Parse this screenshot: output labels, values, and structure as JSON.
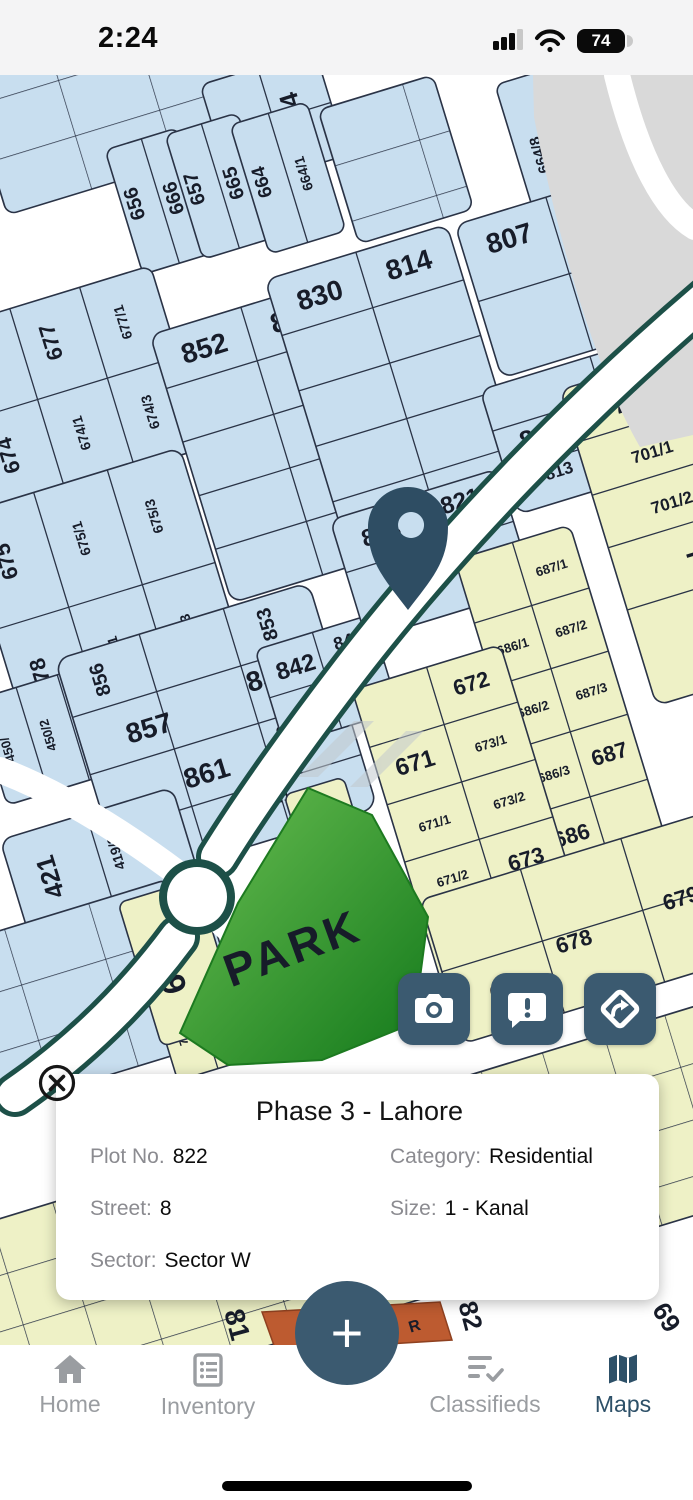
{
  "status_bar": {
    "time": "2:24",
    "battery_percent": "74"
  },
  "map": {
    "park_label": "PARK",
    "selected_plot": "822",
    "colors": {
      "residential_blue": "#c8deef",
      "plot_yellow": "#eef1c6",
      "park_green_light": "#5cb648",
      "park_green_dark": "#15801c",
      "road_teal": "#1d5048",
      "orange_plot": "#bd5b30",
      "accent_slate": "#3b5a70"
    },
    "labels": [
      "644",
      "656",
      "666",
      "657",
      "665",
      "664",
      "664/1",
      "664/8",
      "676",
      "677",
      "677/1",
      "674",
      "674/1",
      "674/3",
      "852",
      "831",
      "830",
      "814",
      "807",
      "801",
      "812",
      "813",
      "805",
      "806",
      "675",
      "675/1",
      "675/3",
      "678",
      "678/1",
      "678/3",
      "450/",
      "450/2",
      "450/3",
      "856",
      "853",
      "857",
      "858",
      "861",
      "862",
      "863",
      "862/1",
      "842",
      "841",
      "841/1",
      "823",
      "821",
      "822",
      "421",
      "419/3",
      "419",
      "701",
      "701/1",
      "701/2",
      "70",
      "687/1",
      "687/2",
      "687/3",
      "687",
      "686/1",
      "686/2",
      "686/3",
      "686",
      "672",
      "673/1",
      "673/2",
      "673",
      "671",
      "671/1",
      "671/2",
      "670",
      "671/3",
      "671/4",
      "670/1",
      "669/1",
      "668/1",
      "766/1",
      "765/1",
      "764/1",
      "763/1",
      "762/1",
      "761/1",
      "651",
      "666",
      "678",
      "679",
      "81",
      "82",
      "69",
      "R"
    ]
  },
  "action_buttons": [
    {
      "icon": "camera"
    },
    {
      "icon": "report"
    },
    {
      "icon": "directions"
    }
  ],
  "info_card": {
    "title": "Phase 3 - Lahore",
    "fields": [
      {
        "label": "Plot No.",
        "value": "822"
      },
      {
        "label": "Category:",
        "value": "Residential"
      },
      {
        "label": "Street:",
        "value": "8"
      },
      {
        "label": "Size:",
        "value": "1 - Kanal"
      },
      {
        "label": "Sector:",
        "value": "Sector W"
      }
    ]
  },
  "fab": {
    "label": "+"
  },
  "nav": {
    "active": "Maps",
    "items": [
      {
        "label": "Home"
      },
      {
        "label": "Inventory"
      },
      {
        "label": "Classifieds"
      },
      {
        "label": "Maps"
      }
    ]
  }
}
